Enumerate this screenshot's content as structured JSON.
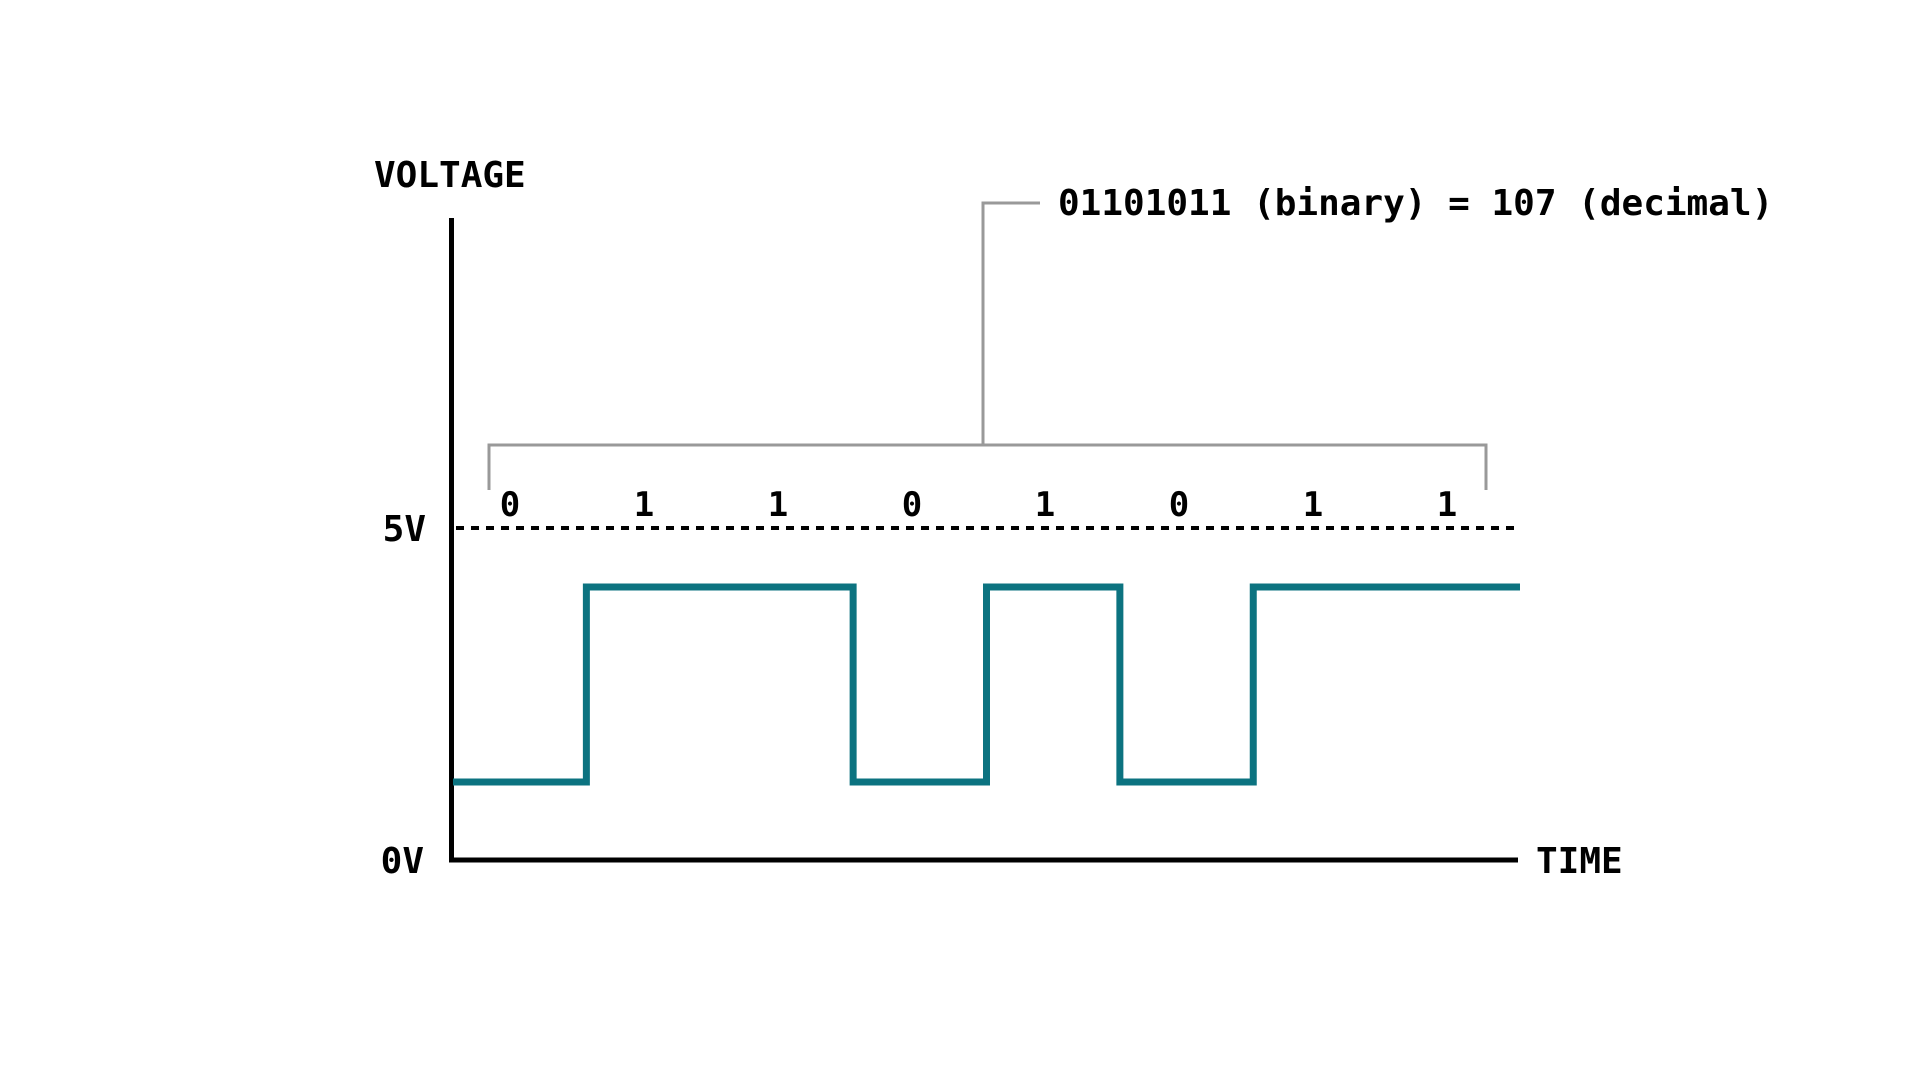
{
  "colors": {
    "waveform_teal": "#0C7380",
    "bracket_gray": "#999999",
    "ink_black": "#000000",
    "background": "#ffffff"
  },
  "diagram": {
    "y_axis_label": "VOLTAGE",
    "x_axis_label": "TIME",
    "tick_high": "5V",
    "tick_low": "0V",
    "annotation": "01101011 (binary) = 107 (decimal)",
    "bits": [
      "0",
      "1",
      "1",
      "0",
      "1",
      "0",
      "1",
      "1"
    ]
  },
  "chart_data": {
    "type": "line",
    "subtype": "digital-timing-waveform",
    "title": "",
    "xlabel": "TIME",
    "ylabel": "VOLTAGE",
    "yticks": [
      "0V",
      "5V"
    ],
    "grid": false,
    "bit_sequence": "01101011",
    "decimal_value": 107,
    "annotation": "01101011 (binary) = 107 (decimal)",
    "reference_line": {
      "label": "5V",
      "style": "dashed"
    },
    "series": [
      {
        "name": "signal",
        "x_bit_index": [
          0,
          1,
          2,
          3,
          4,
          5,
          6,
          7
        ],
        "logic_levels": [
          0,
          1,
          1,
          0,
          1,
          0,
          1,
          1
        ]
      }
    ]
  }
}
